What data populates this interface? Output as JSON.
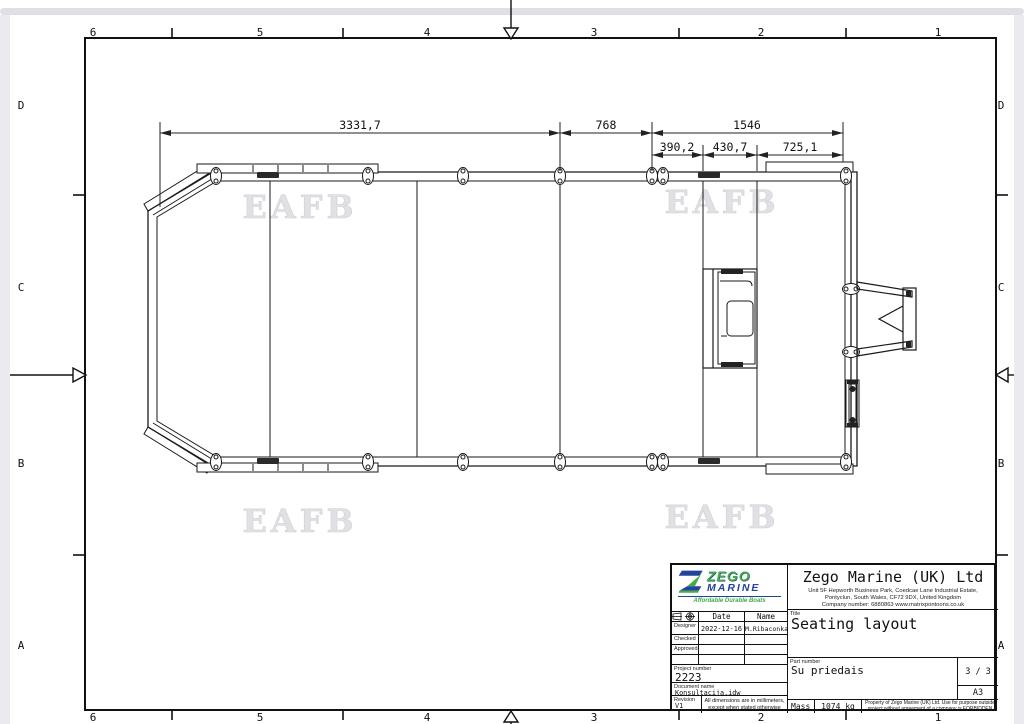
{
  "frame": {
    "top": [
      "6",
      "5",
      "4",
      "3",
      "2",
      "1"
    ],
    "bottom": [
      "6",
      "5",
      "4",
      "3",
      "2",
      "1"
    ],
    "left": [
      "D",
      "C",
      "B",
      "A"
    ],
    "right": [
      "D",
      "C",
      "B",
      "A"
    ]
  },
  "watermark": {
    "text": "EAFB"
  },
  "drawing": {
    "dims": {
      "overall": "3331,7",
      "mid": "768",
      "stern": "1546",
      "sub1": "390,2",
      "sub2": "430,7",
      "sub3": "725,1"
    }
  },
  "title_block": {
    "logo": {
      "zego": "ZEGO",
      "marine": "MARINE",
      "tagline": "Affordable Durable Boats",
      "green": "#3fae49",
      "blue": "#24449c"
    },
    "company": {
      "name": "Zego Marine (UK) Ltd",
      "address_line1": "Unit 5F Hepworth Business Park, Coedcae Lane Industrial Estate,",
      "address_line2": "Pontyclun, South Wales, CF72 9DX, United Kingdom",
      "address_line3": "Company number: 6880863   www.matrixpontoons.co.uk   info@matrixpontoons.co.uk"
    },
    "signoff": {
      "date_header": "Date",
      "name_header": "Name",
      "designer_label": "Designer",
      "designer_date": "2022-12-16",
      "designer_name": "M.Ribaconka",
      "checked_label": "Checked",
      "approved_label": "Approved"
    },
    "project_number_label": "Project number",
    "project_number": "2223",
    "document_name_label": "Document name",
    "document_name": "Konsultacija.idw",
    "revision_label": "Revision",
    "revision": "V1",
    "dimension_note": "All dimensions are in millimeters, except when stated otherwise",
    "title_label": "Title",
    "title": "Seating layout",
    "part_number_label": "Part number",
    "part_number": "Su priedais",
    "sheet": "3 / 3",
    "format": "A3",
    "mass_label": "Mass",
    "mass_value": "1074 kg",
    "property_note": "Property of Zego Marine (UK) Ltd. Use for purpose outside project without agreement of a company is FORBIDDEN"
  }
}
